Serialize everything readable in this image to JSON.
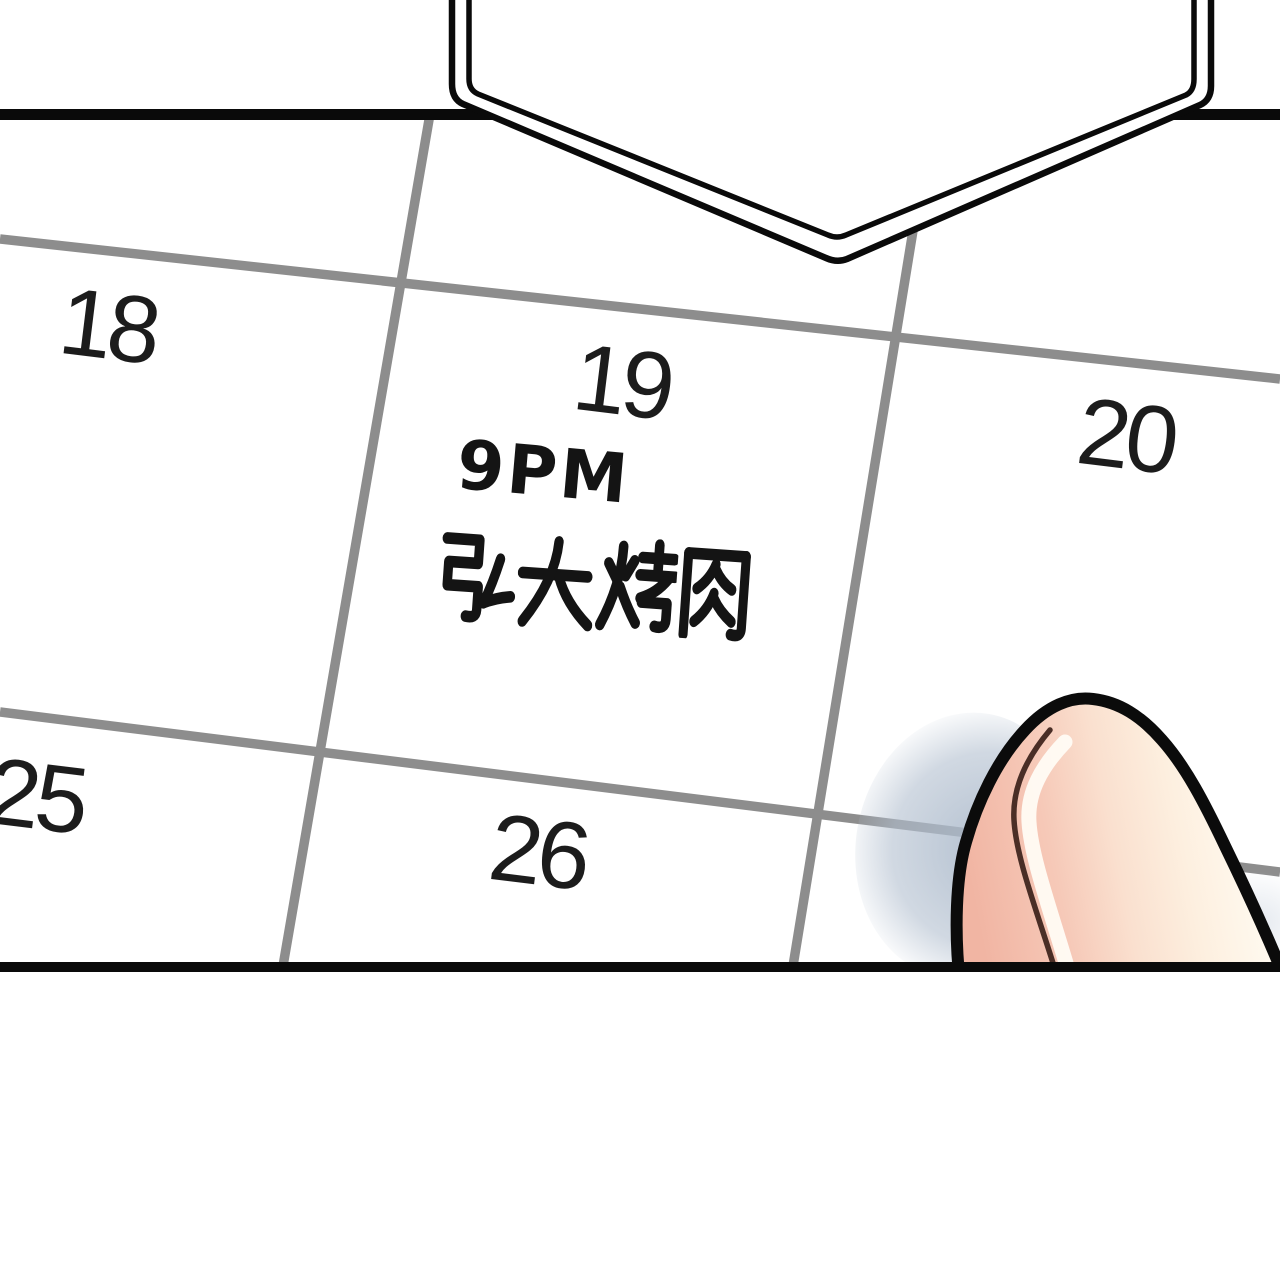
{
  "panel": {
    "background": "#ffffff",
    "border_color": "#0a0a0a",
    "grid_line_color": "#8d8d8d"
  },
  "speech_bubble": {
    "fill": "#ffffff",
    "outline_color": "#0a0a0a",
    "text": ""
  },
  "calendar": {
    "date_color": "#1c1c1c",
    "handwriting_color": "#141414",
    "dates": [
      "18",
      "19",
      "20",
      "25",
      "26"
    ],
    "event": {
      "date": "19",
      "time": "9PM",
      "place": "弘大烤肉"
    }
  },
  "finger": {
    "outline_color": "#0b0b0b",
    "skin_pink": "#f1b5a3",
    "skin_cream": "#fdefdf",
    "highlight": "#fffdf6",
    "crease_color": "#4a2e26",
    "shadow_color": "#acbacb"
  }
}
